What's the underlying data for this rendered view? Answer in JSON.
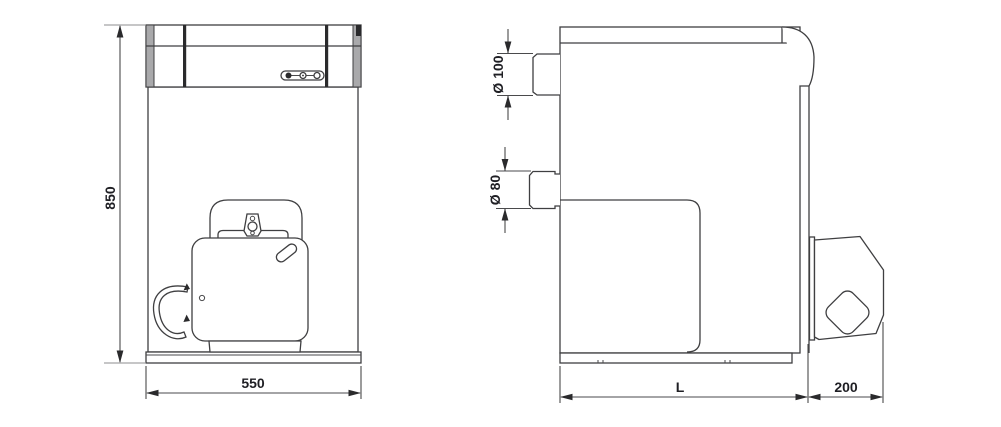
{
  "labels": {
    "front_height": "850",
    "front_width": "550",
    "flue_diameter": "Ø 100",
    "connection_diameter": "Ø 80",
    "depth": "L",
    "burner_projection": "200"
  },
  "colors": {
    "line": "#3f3f41",
    "heavy_line": "#2a2a2c",
    "shaded_edge": "#a9a9ab",
    "dimension_text": "#1f1f24",
    "background": "#ffffff"
  }
}
